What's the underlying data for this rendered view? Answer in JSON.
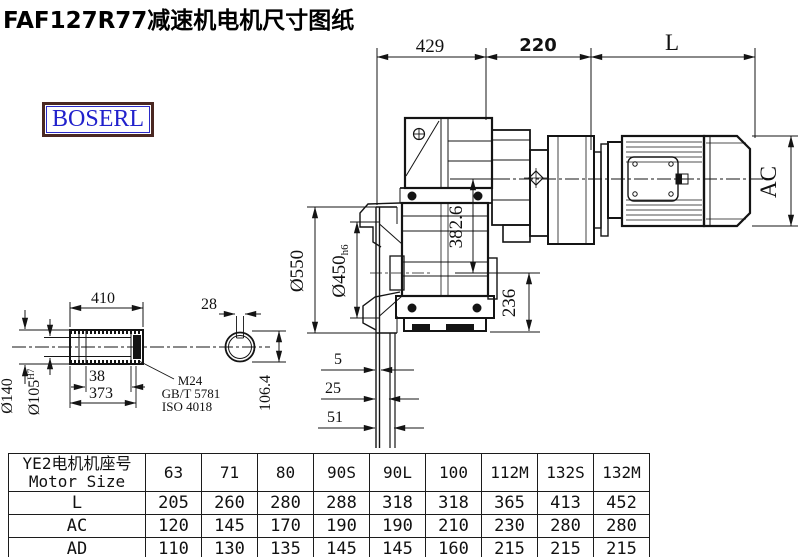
{
  "title": "FAF127R77减速机电机尺寸图纸",
  "logo": "BOSERL",
  "drawing": {
    "dims": {
      "d429": "429",
      "d220": "220",
      "dL": "L",
      "dAC": "AC",
      "d3826": "382.6",
      "d236": "236",
      "d550": "Ø550",
      "d450": "Ø450",
      "d450tol": "h6",
      "d5": "5",
      "d25": "25",
      "d51": "51",
      "d410": "410",
      "d140": "Ø140",
      "d105": "Ø105",
      "d105tol": "H7",
      "d38": "38",
      "d373": "373",
      "d28": "28",
      "d1064": "106.4"
    },
    "notes": {
      "thread": "M24",
      "std1": "GB/T 5781",
      "std2": "ISO 4018"
    }
  },
  "table": {
    "header_cn": "YE2电机机座号",
    "header_en": "Motor Size",
    "columns": [
      "63",
      "71",
      "80",
      "90S",
      "90L",
      "100",
      "112M",
      "132S",
      "132M"
    ],
    "rows": [
      {
        "label": "L",
        "values": [
          "205",
          "260",
          "280",
          "288",
          "318",
          "318",
          "365",
          "413",
          "452"
        ]
      },
      {
        "label": "AC",
        "values": [
          "120",
          "145",
          "170",
          "190",
          "190",
          "210",
          "230",
          "280",
          "280"
        ]
      },
      {
        "label": "AD",
        "values": [
          "110",
          "130",
          "135",
          "145",
          "145",
          "160",
          "215",
          "215",
          "215"
        ]
      }
    ]
  }
}
